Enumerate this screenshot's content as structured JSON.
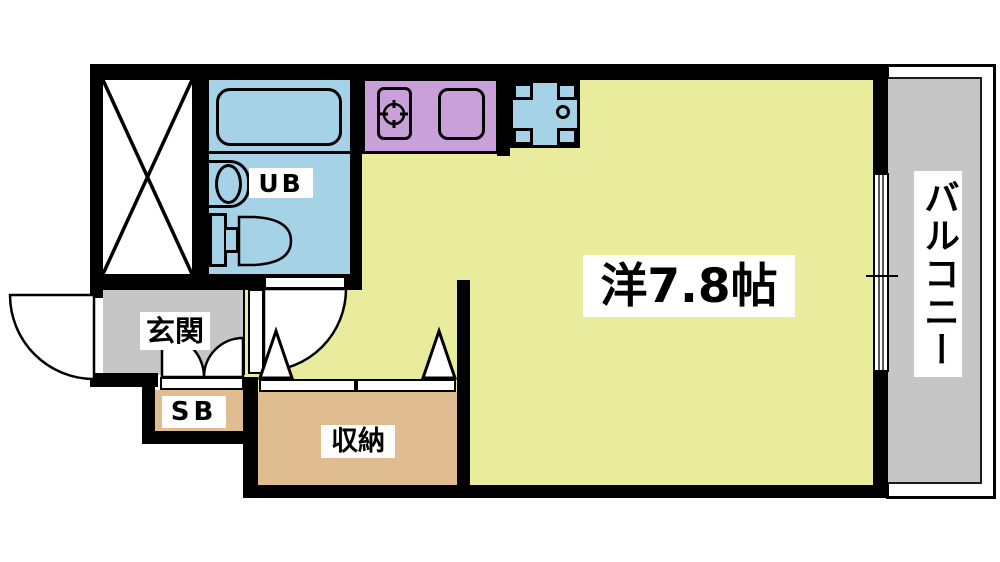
{
  "type": "apartment-floorplan",
  "rooms": {
    "main_room": {
      "label": "洋7.8帖",
      "color": "#e9eb9d"
    },
    "unit_bath": {
      "label": "UB",
      "color": "#a5d2e6"
    },
    "entrance": {
      "label": "玄関",
      "color": "#c6c6c6"
    },
    "shoe_box": {
      "label": "SB",
      "color": "#e0bd90"
    },
    "storage": {
      "label": "収納",
      "color": "#e0bd90"
    },
    "balcony": {
      "label": "バルコニー",
      "color": "#c6c6c6"
    },
    "kitchen": {
      "color": "#c9a0da"
    },
    "washing_machine_pan": {
      "color": "#a5d2e6"
    }
  },
  "colors": {
    "wall": "#000000",
    "background": "#ffffff",
    "label_background": "#ffffff",
    "text": "#000000"
  },
  "fixture_icons": [
    "x-shaft-icon",
    "bathtub-icon",
    "washbasin-icon",
    "toilet-icon",
    "stove-burner-icon",
    "kitchen-sink-icon",
    "washing-machine-pan-icon",
    "drain-icon",
    "entry-door-arc-icon",
    "interior-door-arc-icon",
    "shoe-box-double-door-icon",
    "closet-folding-door-icon",
    "sliding-window-icon"
  ]
}
